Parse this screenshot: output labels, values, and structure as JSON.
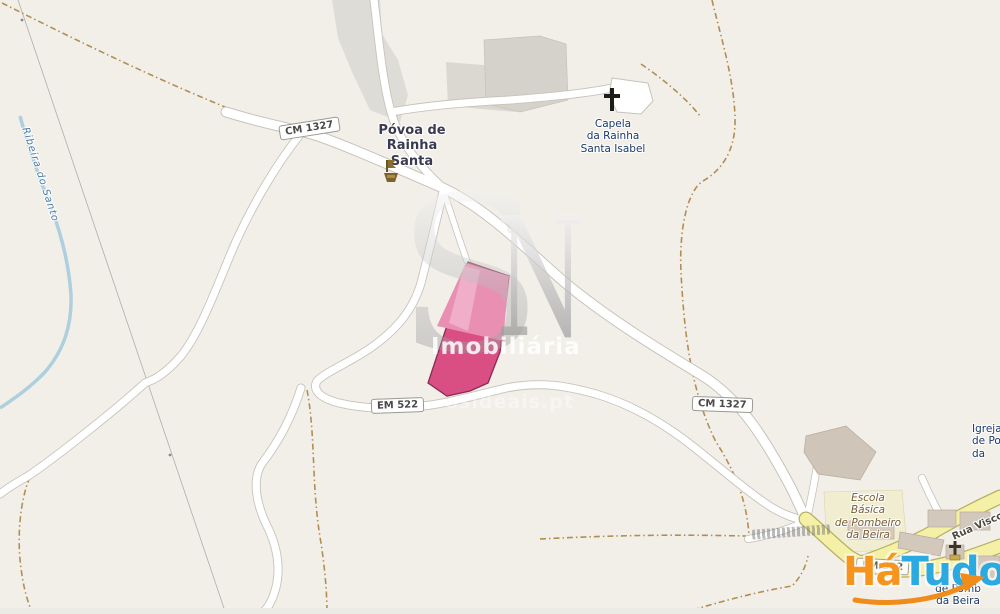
{
  "labels": {
    "village": {
      "line1": "Póvoa de Rainha",
      "line2": "Santa"
    },
    "chapel": {
      "line1": "Capela",
      "line2": "da Rainha",
      "line3": "Santa Isabel"
    },
    "church_right_edge": {
      "line1": "Igreja",
      "line2": "de Po",
      "line3": "da"
    },
    "school": {
      "line1": "Escola",
      "line2": "Básica",
      "line3": "de Pombeiro",
      "line4": "da Beira"
    },
    "church_bottom": {
      "line1": "de Pomb",
      "line2": "da Beira"
    },
    "river": "Ribeira do Santo",
    "street_yellow": "Rua Viscon"
  },
  "badges": {
    "cm1327_a": "CM 1327",
    "em522": "EM 522",
    "cm1327_b": "CM 1327",
    "em522_b": "EM 522"
  },
  "watermark": {
    "letter_s": "S",
    "letter_n": "N",
    "brand": "Imobiliária",
    "website": "osideais.pt"
  },
  "logo": {
    "part1": "Há",
    "part2": "Tudo",
    "color_orange": "#f7941e",
    "color_blue": "#2ba9e1"
  },
  "colors": {
    "land": "#f2efe9",
    "road_fill": "#ffffff",
    "road_casing": "#c8c3bb",
    "yellow_road_fill": "#f4f1a6",
    "yellow_road_casing": "#b9b066",
    "river": "#a6cbdc",
    "track_dashed": "#a87d3a",
    "building": "#d5d2cb",
    "parcel_fill": "#d94f83",
    "parcel_light": "#e88fb2",
    "parcel_lighter": "#f0aec9",
    "parcel_border": "#8a2a52"
  }
}
